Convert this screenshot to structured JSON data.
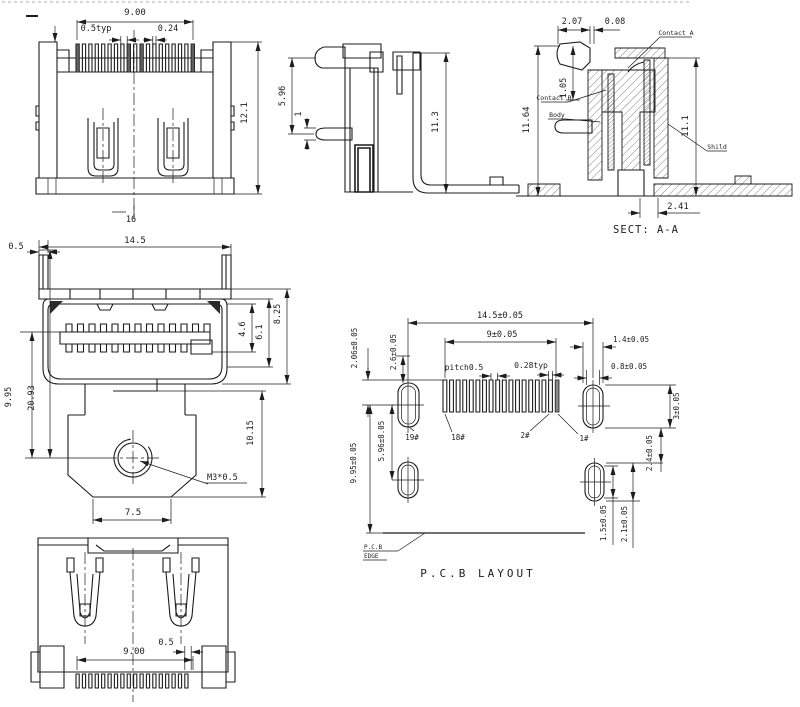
{
  "drawing": {
    "caption_section": "SECT: A-A",
    "caption_pcb": "P.C.B LAYOUT"
  },
  "colors": {
    "line": "#1c1c1c",
    "background": "#ffffff",
    "pad_fill": "#8a8a8a"
  },
  "views": {
    "rear": {
      "dim_pin_row": "9.00",
      "dim_pitch": "0.5typ",
      "dim_pin_width": "0.24",
      "dim_height": "12.1",
      "dim_width": "16"
    },
    "side": {
      "dim_flange_to_lead": "5.96",
      "dim_lead_thickness": "1",
      "dim_height": "11.3"
    },
    "section": {
      "caption": "SECT: A-A",
      "dim_latch_width": "2.07",
      "dim_gap": "0.08",
      "dim_contact_height": "1.05",
      "dim_height_left": "11.64",
      "dim_height_right": "11.1",
      "dim_tail": "2.41",
      "label_contact_a": "Contact A",
      "label_contact_b": "Contact B",
      "label_body": "Body",
      "label_shield": "Shild"
    },
    "front": {
      "dim_lip": "0.5",
      "dim_width": "14.5",
      "dim_opening": "4.6",
      "dim_inner_height": "6.1",
      "dim_shell_height": "8.25",
      "dim_axis_offset": "9.95",
      "dim_total_height": "20.93",
      "dim_boss_height": "10.15",
      "dim_boss_width": "7.5",
      "label_thread": "M3*0.5"
    },
    "bottom": {
      "dim_pin_row": "9.00",
      "dim_offset": "0.5"
    },
    "pcb": {
      "caption": "P.C.B LAYOUT",
      "dim_width": "14.5±0.05",
      "dim_pin_span": "9±0.05",
      "dim_pitch": "pitch0.5",
      "dim_pad_width": "0.28typ",
      "dim_pad19_offset": "2.06±0.05",
      "dim_pad19_width": "2.6±0.05",
      "dim_pad1_width": "1.4±0.05",
      "dim_pad1_slot": "0.8±0.05",
      "dim_pad1_height": "3±0.05",
      "dim_gap_right": "2.4±0.05",
      "dim_mount_offset": "9.95±0.05",
      "dim_mount_gap": "5.96±0.05",
      "dim_hole_slot": "1.5±0.05",
      "dim_hole_height": "2.1±0.05",
      "label_pin19": "19#",
      "label_pin18": "18#",
      "label_pin2": "2#",
      "label_pin1": "1#",
      "label_edge1": "P.C.B",
      "label_edge2": "EDGE"
    }
  }
}
